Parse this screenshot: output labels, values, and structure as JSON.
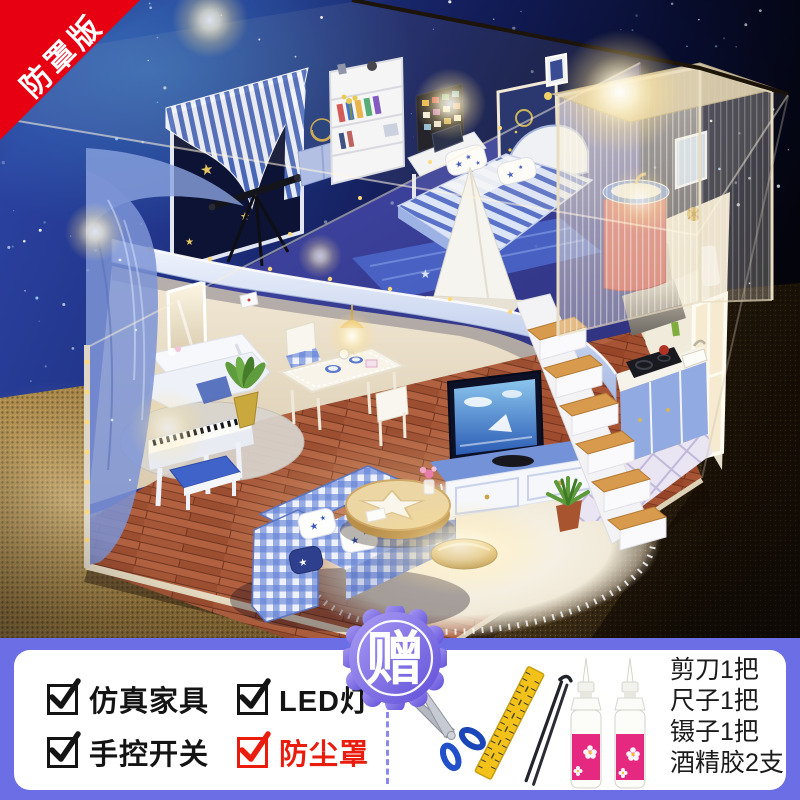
{
  "ribbon": {
    "label": "防罩版"
  },
  "badge": {
    "label": "赠"
  },
  "features": {
    "items": [
      {
        "label": "仿真家具",
        "checked": true,
        "color": "#141414"
      },
      {
        "label": "LED灯",
        "checked": true,
        "color": "#141414"
      },
      {
        "label": "手控开关",
        "checked": true,
        "color": "#141414"
      },
      {
        "label": "防尘罩",
        "checked": true,
        "color": "#ea1c0d"
      }
    ]
  },
  "gifts": {
    "items": [
      {
        "label": "剪刀1把",
        "icon": "scissors-icon"
      },
      {
        "label": "尺子1把",
        "icon": "ruler-icon"
      },
      {
        "label": "镊子1把",
        "icon": "tweezers-icon"
      },
      {
        "label": "酒精胶2支",
        "icon": "glue-bottle-icon"
      }
    ]
  },
  "colors": {
    "panel_bg": "#6b6ee4",
    "ribbon_bg": "#e60012",
    "badge_from": "#ab9df4",
    "badge_to": "#5f4fd8",
    "highlight_red": "#ea1c0d"
  },
  "photo": {
    "description": "DIY miniature loft dollhouse with LED lights inside a clear acrylic dust cover, starry-night backdrop, gold mesh base; loft bedroom with star bedding, telescope, shower cubicle, stairs, kitchen, piano, dining set, TV and gingham sofa"
  }
}
